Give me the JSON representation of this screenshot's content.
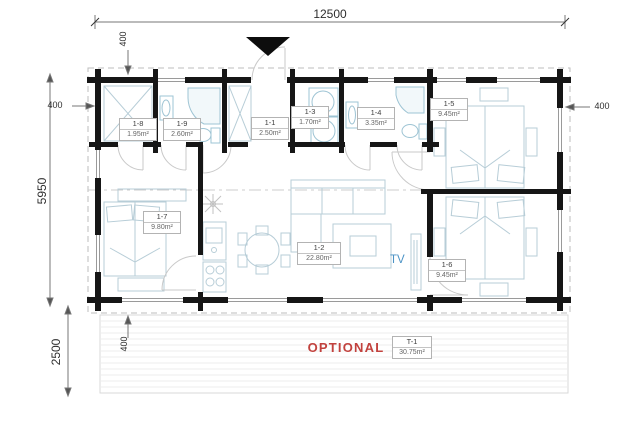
{
  "dimensions": {
    "total_width": "12500",
    "main_depth": "5950",
    "terrace_depth": "2500",
    "overhang_top": "400",
    "overhang_left": "400",
    "overhang_right": "400",
    "overhang_bottom": "400"
  },
  "rooms": [
    {
      "id": "1-1",
      "area": "2.50m²"
    },
    {
      "id": "1-2",
      "area": "22.80m²"
    },
    {
      "id": "1-3",
      "area": "1.70m²"
    },
    {
      "id": "1-4",
      "area": "3.35m²"
    },
    {
      "id": "1-5",
      "area": "9.45m²"
    },
    {
      "id": "1-6",
      "area": "9.45m²"
    },
    {
      "id": "1-7",
      "area": "9.80m²"
    },
    {
      "id": "1-8",
      "area": "1.95m²"
    },
    {
      "id": "1-9",
      "area": "2.60m²"
    }
  ],
  "terrace": {
    "note": "OPTIONAL",
    "id": "T-1",
    "area": "30.75m²"
  },
  "labels": {
    "tv": "TV"
  },
  "colors": {
    "wall": "#161616",
    "furniture": "#b7cdd7",
    "fixture": "#9ec4d4",
    "optional_red": "#c2423e",
    "tv_blue": "#4a92c5"
  }
}
